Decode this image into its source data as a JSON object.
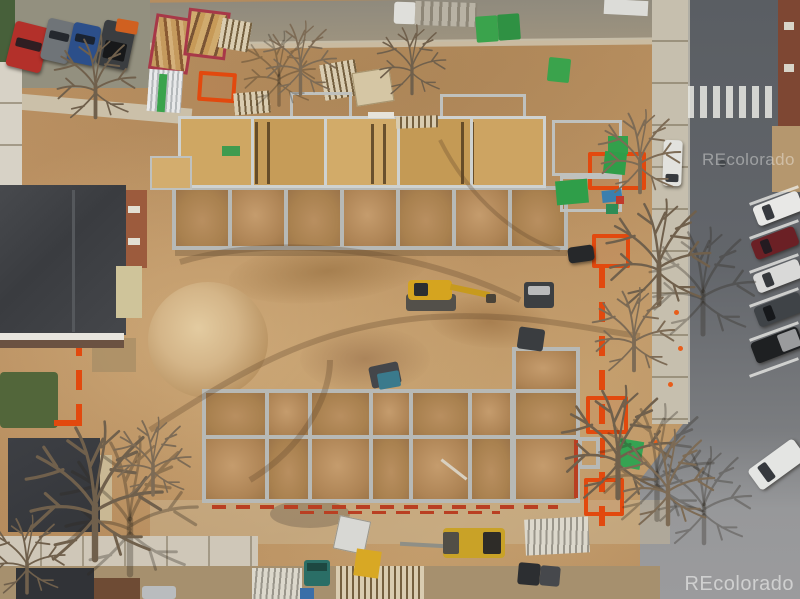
{
  "image": {
    "type": "aerial-drone-photo",
    "subject": "Residential construction site, overhead view",
    "width_px": 800,
    "height_px": 599
  },
  "watermark": {
    "text": "REcolorado",
    "positions": [
      "top-right",
      "bottom-right"
    ],
    "color": "#ffffff"
  },
  "scene": {
    "description": "Top-down drone photo of a townhome construction site: wood-framed units with OSB subfloor at top, open concrete foundation grid below, large dirt piles, excavators and equipment, orange safety fencing, bare winter trees, streets with angle-parked cars on the right and staging/dumpsters along the top",
    "elements": [
      "framed-townhome-row",
      "foundation-grid",
      "sand-pile",
      "excavator",
      "skid-steer",
      "dumpsters-with-lumber",
      "parked-cars",
      "crosswalk",
      "orange-safety-fence",
      "bare-trees",
      "existing-house-roofs",
      "lumber-stacks",
      "portable-toilets",
      "sidewalks",
      "red-water-pipes"
    ],
    "palette": {
      "dirt": "#bb9165",
      "dirt_light": "#cfae7e",
      "dirt_dark": "#9c764a",
      "asphalt": "#5d6165",
      "asphalt_light": "#97989a",
      "concrete": "#c9c1b0",
      "osb_wood": "#c9a05e",
      "stem_wall": "#b7b9b6",
      "roof_dark": "#3b3d41",
      "safety_orange": "#e2490e",
      "machine_yellow": "#d5a41f",
      "portable_green": "#3aa34c",
      "lawn_green": "#52663a",
      "truck_red": "#b3302a",
      "car_blue": "#2c4f8a",
      "dumpster_red": "#a83848"
    },
    "counts": {
      "right_street_parked_cars": 6,
      "top_left_parked_vehicles": 4,
      "foundation_cells_visible": 14,
      "framed_units": 5
    }
  }
}
